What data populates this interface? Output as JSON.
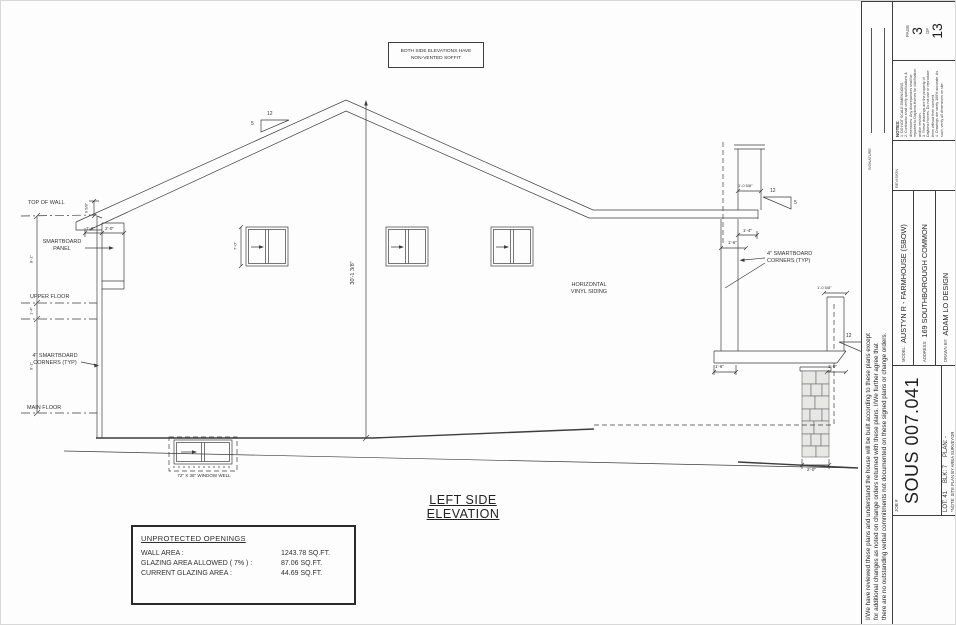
{
  "note_box": {
    "line1": "BOTH SIDE ELEVATIONS HAVE",
    "line2": "NON-VENTED SOFFIT"
  },
  "labels": {
    "top_of_wall": "TOP OF WALL",
    "smartboard_panel_l1": "SMARTBOARD",
    "smartboard_panel_l2": "PANEL",
    "upper_floor": "UPPER FLOOR",
    "corners_left_l1": "4\" SMARTBOARD",
    "corners_left_l2": "CORNERS (TYP)",
    "main_floor": "MAIN FLOOR",
    "siding_l1": "HORIZONTAL",
    "siding_l2": "VINYL SIDING",
    "corners_right_l1": "4\" SMARTBOARD",
    "corners_right_l2": "CORNERS (TYP)",
    "window_well": "72\" X 36\" WINDOW WELL"
  },
  "dimensions": {
    "overall_height": "30'-1 3/8\"",
    "wall_top": "9 5/8\"",
    "eave_left": "1'-6\"",
    "panel_width": "2'-0\"",
    "upper_wall": "8'-1\"",
    "floor_depth": "1'-4\"",
    "main_wall": "9'-1\"",
    "window_height": "7'-0\"",
    "dormer_width": "1'-0 5/8\"",
    "fascia_1": "1'-4\"",
    "fascia_2": "1'-6\"",
    "corner_right": "1'-0 5/8\"",
    "porch_left": "1'-6\"",
    "porch_right": "1'-0\"",
    "pillar_width": "2'-0\"",
    "pitch_run": "12",
    "pitch_rise": "5"
  },
  "title": "LEFT SIDE ELEVATION",
  "openings_box": {
    "header": "UNPROTECTED OPENINGS",
    "rows": [
      {
        "label": "WALL AREA :",
        "value": "1243.78 SQ.FT."
      },
      {
        "label": "GLAZING AREA ALLOWED ( 7% ) :",
        "value": "87.06 SQ.FT."
      },
      {
        "label": "CURRENT GLAZING AREA :",
        "value": "44.69 SQ.FT."
      }
    ]
  },
  "title_block": {
    "agreement_l1": "I/We have reviewed these plans and understand the house will be built according to these plans except",
    "agreement_l2": "for additional changes as noted on change orders returned with these plans. I/We further agree that",
    "agreement_l3": "there are no outstanding verbal commitments not documented on these signed plans or change orders.",
    "signature_label": "SIGNATURE",
    "job_label": "JOB #",
    "job_number": "SOUS 007.041",
    "lot": "LOT: 41",
    "blk": "BLK: 7",
    "plan": "PLAN: -",
    "site_note": "*NOTE: SITE PLAN BY AREA SURVEYOR",
    "model_label": "MODEL:",
    "model_value": "AUSTYN R - FARMHOUSE (SBOW)",
    "address_label": "ADDRESS:",
    "address_value": "169 SOUTHBOROUGH COMMON",
    "drawn_by_label": "DRAWN BY:",
    "drawn_by_value": "ADAM LO DESIGN",
    "revision_label": "REVISION",
    "notes_title": "NOTES:",
    "notes": [
      "1. DO NOT SCALE DIMENSIONS.",
      "2. Contractor shall verify specifications & dimensions. Any discrepancies shall be reported to Daytona Homes for clarification and/or revision.",
      "3. These drawings are the property of Daytona Homes. Do not use or reproduce them without their consent.",
      "4. Drawings are rarely 100% accurate. As such, verify all dimensions on site."
    ],
    "page_label": "PAGE",
    "page_number": "3",
    "of_label": "OF",
    "page_total": "13"
  }
}
